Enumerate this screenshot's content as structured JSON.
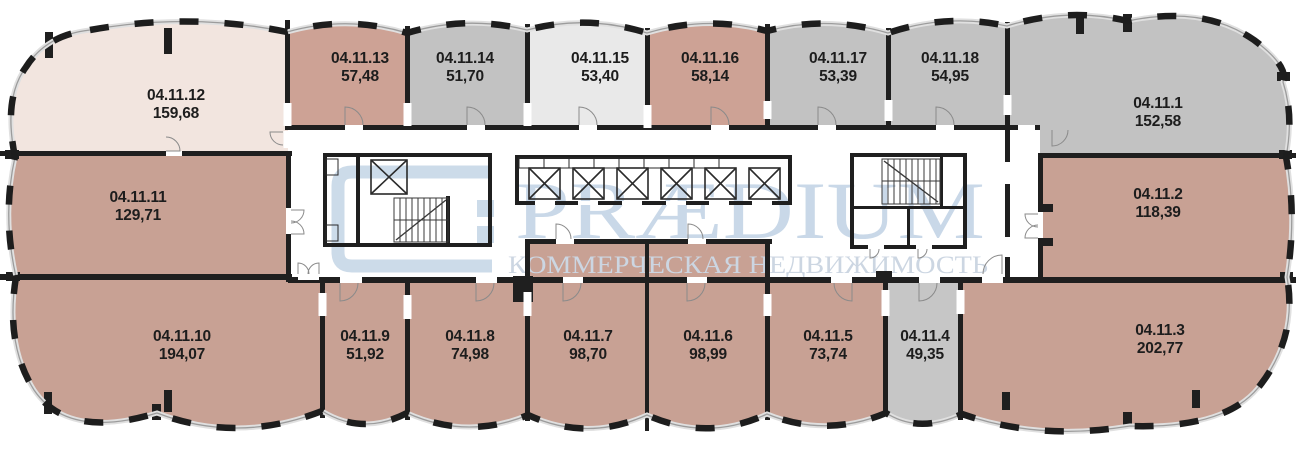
{
  "plan": {
    "title": "floor-plan",
    "watermark": {
      "brand": "PRÆDIUM",
      "tagline": "КОММЕРЧЕСКАЯ НЕДВИЖИМОСТЬ",
      "color": "#c9d8e8"
    },
    "palette": {
      "unit_tan": "#c8a194",
      "unit_tan_light": "#cda295",
      "unit_gray": "#c2c2c2",
      "unit_cream": "#f2e5df",
      "unit_lightgray": "#e9e9e9",
      "wall": "#1f1f1f",
      "corridor": "#ffffff"
    },
    "rooms": [
      {
        "id": "04.11.1",
        "area": "152,58",
        "color": "#c2c2c2"
      },
      {
        "id": "04.11.2",
        "area": "118,39",
        "color": "#c8a194"
      },
      {
        "id": "04.11.3",
        "area": "202,77",
        "color": "#c8a194"
      },
      {
        "id": "04.11.4",
        "area": "49,35",
        "color": "#c6c6c6"
      },
      {
        "id": "04.11.5",
        "area": "73,74",
        "color": "#c8a194"
      },
      {
        "id": "04.11.6",
        "area": "98,99",
        "color": "#c8a194"
      },
      {
        "id": "04.11.7",
        "area": "98,70",
        "color": "#c8a194"
      },
      {
        "id": "04.11.8",
        "area": "74,98",
        "color": "#c8a194"
      },
      {
        "id": "04.11.9",
        "area": "51,92",
        "color": "#c8a194"
      },
      {
        "id": "04.11.10",
        "area": "194,07",
        "color": "#c8a194"
      },
      {
        "id": "04.11.11",
        "area": "129,71",
        "color": "#c8a194"
      },
      {
        "id": "04.11.12",
        "area": "159,68",
        "color": "#f2e5df"
      },
      {
        "id": "04.11.13",
        "area": "57,48",
        "color": "#cda295"
      },
      {
        "id": "04.11.14",
        "area": "51,70",
        "color": "#c2c2c2"
      },
      {
        "id": "04.11.15",
        "area": "53,40",
        "color": "#e9e9e9"
      },
      {
        "id": "04.11.16",
        "area": "58,14",
        "color": "#cda295"
      },
      {
        "id": "04.11.17",
        "area": "53,39",
        "color": "#c2c2c2"
      },
      {
        "id": "04.11.18",
        "area": "54,95",
        "color": "#c2c2c2"
      }
    ]
  }
}
